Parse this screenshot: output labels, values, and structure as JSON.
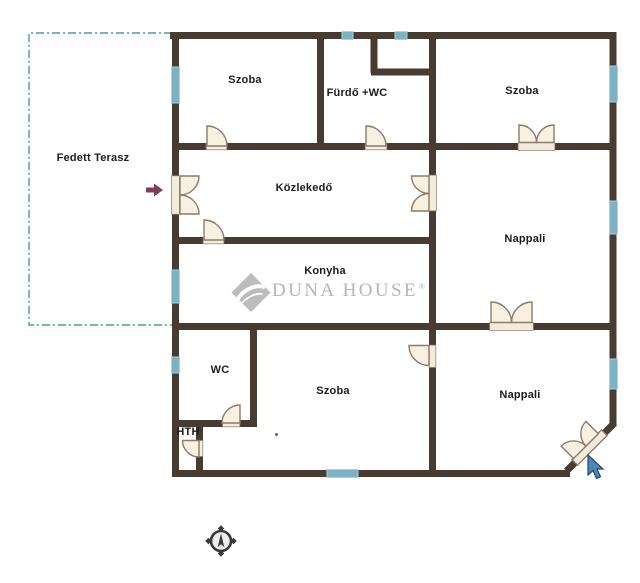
{
  "plan": {
    "rooms": [
      {
        "id": "fedett-terasz",
        "label": "Fedett Terasz"
      },
      {
        "id": "szoba-top-left",
        "label": "Szoba"
      },
      {
        "id": "furdo-wc",
        "label": "Fürdő +WC"
      },
      {
        "id": "szoba-top-right",
        "label": "Szoba"
      },
      {
        "id": "kozlekedo",
        "label": "Közlekedő"
      },
      {
        "id": "nappali-middle",
        "label": "Nappali"
      },
      {
        "id": "konyha",
        "label": "Konyha"
      },
      {
        "id": "wc",
        "label": "WC"
      },
      {
        "id": "szoba-bottom",
        "label": "Szoba"
      },
      {
        "id": "nappali-bottom",
        "label": "Nappali"
      },
      {
        "id": "hth",
        "label": "HTH"
      }
    ],
    "watermark": {
      "brand": "DUNA HOUSE",
      "registered": "®"
    },
    "icons": {
      "compass": "compass-rose-icon",
      "entrance_arrow": "entrance-arrow-icon",
      "cursor": "mouse-cursor-icon"
    },
    "colors": {
      "wall": "#473B32",
      "window_glass": "#7DB2C3",
      "door_leaf": "#F8F1E2",
      "terrace_dash": "#3E9DAE",
      "entrance_arrow": "#7C3E58",
      "watermark_gray": "#B6B6B6",
      "cursor_blue": "#4E86B5",
      "background": "#FFFFFF"
    }
  }
}
